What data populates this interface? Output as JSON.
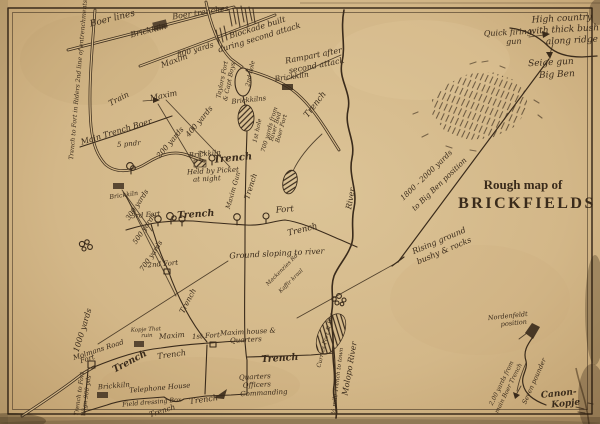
{
  "caption": "Rough map of BRICKFIELDS",
  "colors": {
    "paper": "#dcc497",
    "paper_mid": "#d3b788",
    "paper_edge": "#bf9f6e",
    "ink": "#3a2b1b"
  },
  "title": {
    "line1": "Rough map of",
    "line2": "BRICKFIELDS"
  },
  "map": {
    "width": 600,
    "height": 424,
    "labels": [
      {
        "text": "Boer lines",
        "x": 113,
        "y": 21,
        "r": -14,
        "s": 9
      },
      {
        "text": "Brickkiln",
        "x": 149,
        "y": 33,
        "r": -14,
        "s": 8
      },
      {
        "text": "Boer trenches",
        "x": 201,
        "y": 15,
        "r": -9,
        "s": 8
      },
      {
        "text": "800 yards",
        "x": 196,
        "y": 52,
        "r": -16,
        "s": 7.5
      },
      {
        "text": "Maxim",
        "x": 175,
        "y": 63,
        "r": -20,
        "s": 8
      },
      {
        "text": "Maxim",
        "x": 164,
        "y": 98,
        "r": -12,
        "s": 8
      },
      {
        "text": "Train",
        "x": 120,
        "y": 101,
        "r": -28,
        "s": 8
      },
      {
        "text": "Main Trench Boer",
        "x": 117,
        "y": 134,
        "r": -17,
        "s": 8
      },
      {
        "text": "5 pndr",
        "x": 129,
        "y": 146,
        "r": -5,
        "s": 7
      },
      {
        "text": "Trench to Fort in Riders 2nd line of entrenchments",
        "x": 80,
        "y": 80,
        "r": -85,
        "s": 6.2
      },
      {
        "text": "Blockade built",
        "x": 258,
        "y": 30,
        "r": -17,
        "s": 8
      },
      {
        "text": "during second attack",
        "x": 260,
        "y": 40,
        "r": -17,
        "s": 8
      },
      {
        "text": "Rampart after",
        "x": 314,
        "y": 58,
        "r": -11,
        "s": 8
      },
      {
        "text": "second attack",
        "x": 317,
        "y": 68,
        "r": -11,
        "s": 8
      },
      {
        "text": "Brickkiln",
        "x": 292,
        "y": 79,
        "r": -8,
        "s": 7.5
      },
      {
        "text": "Trench",
        "x": 317,
        "y": 106,
        "r": -52,
        "s": 8.5
      },
      {
        "text": "Taylors Fort",
        "x": 224,
        "y": 80,
        "r": -78,
        "s": 6.2
      },
      {
        "text": "& Capt Boys",
        "x": 231,
        "y": 82,
        "r": -78,
        "s": 6.2
      },
      {
        "text": "2nd hole",
        "x": 252,
        "y": 74,
        "r": -78,
        "s": 6
      },
      {
        "text": "Brickkilns",
        "x": 249,
        "y": 102,
        "r": -6,
        "s": 6.8
      },
      {
        "text": "1st hole",
        "x": 259,
        "y": 131,
        "r": -78,
        "s": 6
      },
      {
        "text": "700 yards from",
        "x": 271,
        "y": 130,
        "r": -74,
        "s": 6
      },
      {
        "text": "River Bed",
        "x": 277,
        "y": 127,
        "r": -74,
        "s": 6
      },
      {
        "text": "Boer Fort",
        "x": 283,
        "y": 129,
        "r": -74,
        "s": 6
      },
      {
        "text": "400 yards",
        "x": 201,
        "y": 123,
        "r": -50,
        "s": 7.5
      },
      {
        "text": "200 yards",
        "x": 172,
        "y": 144,
        "r": -50,
        "s": 7.5
      },
      {
        "text": "Brickkiln",
        "x": 205,
        "y": 156,
        "r": -5,
        "s": 7
      },
      {
        "text": "Trench",
        "x": 233,
        "y": 161,
        "r": -5,
        "s": 10,
        "f": "b"
      },
      {
        "text": "Held by Picket",
        "x": 213,
        "y": 173,
        "r": -3,
        "s": 7
      },
      {
        "text": "at night",
        "x": 207,
        "y": 181,
        "r": -3,
        "s": 7
      },
      {
        "text": "Maxim Gun",
        "x": 235,
        "y": 191,
        "r": -74,
        "s": 6.5
      },
      {
        "text": "Trench",
        "x": 253,
        "y": 187,
        "r": -72,
        "s": 7.5
      },
      {
        "text": "Brickkiln",
        "x": 124,
        "y": 197,
        "r": -8,
        "s": 6.3
      },
      {
        "text": "300 yards",
        "x": 139,
        "y": 206,
        "r": -56,
        "s": 7
      },
      {
        "text": "500 yards",
        "x": 146,
        "y": 230,
        "r": -56,
        "s": 7
      },
      {
        "text": "700 yards",
        "x": 153,
        "y": 257,
        "r": -56,
        "s": 7
      },
      {
        "text": "3rd Fort",
        "x": 146,
        "y": 217,
        "r": -5,
        "s": 7
      },
      {
        "text": "Trench",
        "x": 196,
        "y": 217,
        "r": -4,
        "s": 9.5,
        "f": "b"
      },
      {
        "text": "Fort",
        "x": 285,
        "y": 212,
        "r": -5,
        "s": 8.5
      },
      {
        "text": "Trench",
        "x": 303,
        "y": 232,
        "r": -14,
        "s": 8.5
      },
      {
        "text": "Ground sloping to river",
        "x": 277,
        "y": 256,
        "r": -3,
        "s": 8
      },
      {
        "text": "2nd Fort",
        "x": 163,
        "y": 266,
        "r": -5,
        "s": 7
      },
      {
        "text": "Trench",
        "x": 190,
        "y": 302,
        "r": -62,
        "s": 7.5
      },
      {
        "text": "Mackenzies Rd",
        "x": 283,
        "y": 271,
        "r": -45,
        "s": 5.5
      },
      {
        "text": "Kaffir kraal",
        "x": 292,
        "y": 282,
        "r": -45,
        "s": 5.5
      },
      {
        "text": "River",
        "x": 353,
        "y": 199,
        "r": -80,
        "s": 8
      },
      {
        "text": "High country",
        "x": 562,
        "y": 21,
        "r": -3,
        "s": 9
      },
      {
        "text": "with thick bush",
        "x": 564,
        "y": 32,
        "r": -3,
        "s": 9
      },
      {
        "text": "along ridge",
        "x": 572,
        "y": 43,
        "r": -3,
        "s": 9
      },
      {
        "text": "Quick firing",
        "x": 508,
        "y": 35,
        "r": -3,
        "s": 8
      },
      {
        "text": "gun",
        "x": 514,
        "y": 44,
        "r": -3,
        "s": 8
      },
      {
        "text": "Seige gun",
        "x": 551,
        "y": 65,
        "r": -3,
        "s": 9
      },
      {
        "text": "Big Ben",
        "x": 557,
        "y": 77,
        "r": -3,
        "s": 9
      },
      {
        "text": "1800 - 2000 yards",
        "x": 428,
        "y": 177,
        "r": -44,
        "s": 7.5
      },
      {
        "text": "to Big Ben position",
        "x": 441,
        "y": 186,
        "r": -44,
        "s": 7.5
      },
      {
        "text": "Rough map of",
        "x": 523,
        "y": 189,
        "r": 0,
        "s": 13,
        "f": "t"
      },
      {
        "text": "BRICKFIELDS",
        "x": 527,
        "y": 208,
        "r": 0,
        "s": 16,
        "f": "T",
        "ls": 2.5
      },
      {
        "text": "Rising ground",
        "x": 440,
        "y": 243,
        "r": -23,
        "s": 8
      },
      {
        "text": "bushy & rocks",
        "x": 445,
        "y": 253,
        "r": -23,
        "s": 8
      },
      {
        "text": "1000 yards",
        "x": 85,
        "y": 331,
        "r": -73,
        "s": 8
      },
      {
        "text": "Molmans Road",
        "x": 99,
        "y": 352,
        "r": -18,
        "s": 7
      },
      {
        "text": "Fort",
        "x": 88,
        "y": 361,
        "r": -18,
        "s": 7
      },
      {
        "text": "Trench",
        "x": 131,
        "y": 364,
        "r": -28,
        "s": 9.5,
        "f": "b"
      },
      {
        "text": "Kopje That",
        "x": 146,
        "y": 331,
        "r": -3,
        "s": 5.5
      },
      {
        "text": "ruin",
        "x": 147,
        "y": 337,
        "r": -3,
        "s": 5.5
      },
      {
        "text": "Maxim",
        "x": 172,
        "y": 338,
        "r": -5,
        "s": 7.5
      },
      {
        "text": "Trench",
        "x": 172,
        "y": 357,
        "r": -8,
        "s": 8
      },
      {
        "text": "1st Fort",
        "x": 206,
        "y": 338,
        "r": -4,
        "s": 7
      },
      {
        "text": "Trench to Fort",
        "x": 81,
        "y": 394,
        "r": -82,
        "s": 6
      },
      {
        "text": "Wign 900 yds",
        "x": 88,
        "y": 396,
        "r": -82,
        "s": 6
      },
      {
        "text": "Brickkiln",
        "x": 114,
        "y": 388,
        "r": -5,
        "s": 7
      },
      {
        "text": "Telephone House",
        "x": 160,
        "y": 390,
        "r": -5,
        "s": 7
      },
      {
        "text": "Field dressing Box",
        "x": 152,
        "y": 404,
        "r": -5,
        "s": 6.3
      },
      {
        "text": "Trench",
        "x": 163,
        "y": 413,
        "r": -18,
        "s": 7.5
      },
      {
        "text": "Trench",
        "x": 204,
        "y": 402,
        "r": -8,
        "s": 8
      },
      {
        "text": "Maxim house &",
        "x": 248,
        "y": 334,
        "r": -3,
        "s": 7
      },
      {
        "text": "Quarters",
        "x": 246,
        "y": 342,
        "r": -3,
        "s": 7
      },
      {
        "text": "Trench",
        "x": 280,
        "y": 361,
        "r": -4,
        "s": 9.5,
        "f": "b"
      },
      {
        "text": "Quarters",
        "x": 255,
        "y": 379,
        "r": -3,
        "s": 7
      },
      {
        "text": "Officers",
        "x": 257,
        "y": 387,
        "r": -3,
        "s": 7
      },
      {
        "text": "Commanding",
        "x": 264,
        "y": 395,
        "r": -3,
        "s": 7
      },
      {
        "text": "Curries Fort & Bar",
        "x": 327,
        "y": 341,
        "r": -76,
        "s": 5.8
      },
      {
        "text": "Molopo River",
        "x": 352,
        "y": 369,
        "r": -80,
        "s": 8
      },
      {
        "text": "½ mile Trench to town",
        "x": 339,
        "y": 381,
        "r": -83,
        "s": 5.8
      },
      {
        "text": "Nordenfeldt",
        "x": 508,
        "y": 318,
        "r": -6,
        "s": 6.5
      },
      {
        "text": "position",
        "x": 514,
        "y": 325,
        "r": -6,
        "s": 6.5
      },
      {
        "text": "2,00 yards from",
        "x": 503,
        "y": 384,
        "r": -64,
        "s": 6
      },
      {
        "text": "main Boer Trench",
        "x": 510,
        "y": 389,
        "r": -64,
        "s": 6
      },
      {
        "text": "Seven pounder",
        "x": 536,
        "y": 382,
        "r": -66,
        "s": 6.5
      },
      {
        "text": "Canon-",
        "x": 559,
        "y": 396,
        "r": -6,
        "s": 9,
        "f": "bb"
      },
      {
        "text": "Kopje",
        "x": 566,
        "y": 406,
        "r": -6,
        "s": 9,
        "f": "bb"
      }
    ]
  }
}
